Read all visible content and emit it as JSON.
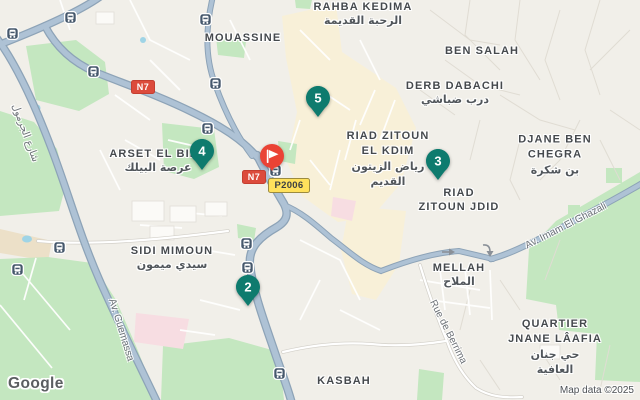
{
  "map": {
    "provider_logo": "Google",
    "attribution": "Map data ©2025",
    "area_labels": {
      "rahba_kedima": {
        "lines": [
          "RAHBA KEDIMA",
          "الرحبة القديمة"
        ]
      },
      "mouassine": {
        "lines": [
          "MOUASSINE"
        ]
      },
      "ben_salah": {
        "lines": [
          "BEN SALAH"
        ]
      },
      "derb_dabachi": {
        "lines": [
          "DERB DABACHI",
          "درب ضباشي"
        ]
      },
      "riad_zitoun_el_kdim": {
        "lines": [
          "RIAD ZITOUN",
          "EL KDIM",
          "رياض الزيتون",
          "القديم"
        ]
      },
      "djane_ben_chegra": {
        "lines": [
          "DJANE BEN",
          "CHEGRA",
          "بن شكرة"
        ]
      },
      "riad_zitoun_jdid": {
        "lines": [
          "RIAD",
          "ZITOUN JDID"
        ]
      },
      "arset_el_bilk": {
        "lines": [
          "ARSET EL BILK",
          "عرصة البيلك"
        ]
      },
      "sidi_mimoun": {
        "lines": [
          "SIDI MIMOUN",
          "سيدي ميمون"
        ]
      },
      "mellah": {
        "lines": [
          "MELLAH",
          "الملاح"
        ]
      },
      "quartier_jnane_laafia": {
        "lines": [
          "QUARTIER",
          "JNANE LÂAFIA",
          "حي جنان",
          "العافية"
        ]
      },
      "kasbah": {
        "lines": [
          "KASBAH"
        ]
      }
    },
    "road_labels": {
      "av_guemassa": "Av. Guemassa",
      "av_imam_el_ghazali": "Av. Imam El Ghazali",
      "rue_de_berrima": "Rue de Berrima",
      "rue_el_jarmoul": "شارع الجرمول"
    },
    "route_badges": {
      "n7": "N7",
      "p2006": "P2006"
    },
    "markers": {
      "m2": "2",
      "m3": "3",
      "m4": "4",
      "m5": "5"
    },
    "colors": {
      "marker_teal": "#0e7b6e",
      "destination_red": "#ea4335",
      "road_fill": "#aec2d5",
      "road_casing": "#8da3b7",
      "park_green": "#c4e7c0",
      "medina_cream": "#f8f0d8",
      "background": "#f1efe9",
      "badge_red": "#dc4b3c",
      "badge_yellow": "#ffe15c",
      "transit_icon_bg": "#46586c"
    }
  }
}
